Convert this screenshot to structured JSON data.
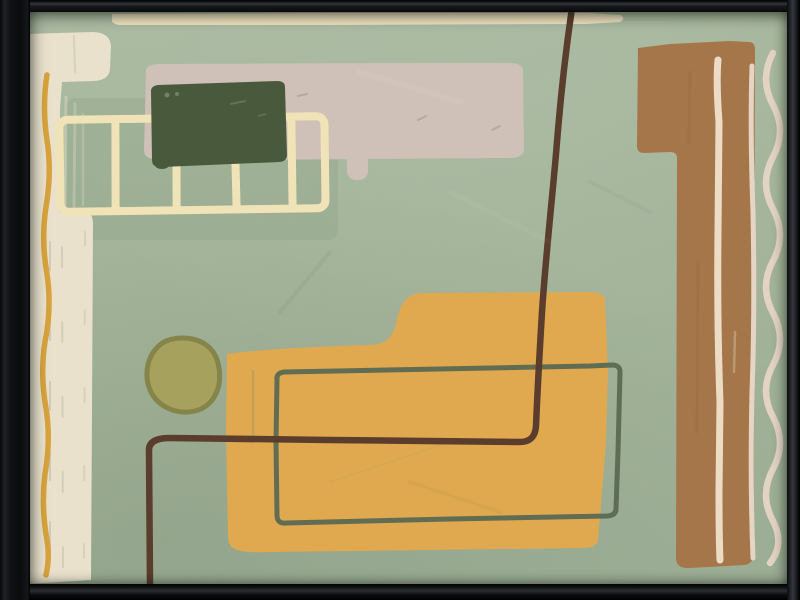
{
  "artwork": {
    "kind": "framed-abstract-painting",
    "frame": {
      "color": "#0d0e11",
      "bevel_highlight": "#33363b"
    },
    "palette": {
      "sage": "#a3b49a",
      "sage_panel": "#8ba083",
      "cream_bar": "#e9e1cc",
      "cream_streak": "#d9d5be",
      "grey_streak": "#a9ab9b",
      "top_strip": "#eee2bf",
      "ladder_cream": "#f1e3b8",
      "taupe": "#cfc1b7",
      "taupe_scratch": "#a8998f",
      "forest_green": "#49593c",
      "forest_mark": "#74855c",
      "olive_fill": "#a6a15d",
      "olive_edge": "#85854a",
      "mustard": "#e1a94f",
      "mustard_crease": "#8d9468",
      "ochre_line": "#d79f35",
      "teal_line": "#5a6952",
      "umber_line": "#5a3d2c",
      "sienna": "#a6764b",
      "sienna_shade": "#8e6038",
      "blush_line_inner": "#ecdcc6",
      "blush_line_edge": "#e6d5c5",
      "blush_wave": "#e3d3c5"
    },
    "shapes": [
      "top-strip",
      "left-cream-bar",
      "ochre-squiggle",
      "sage-panel",
      "taupe-bar",
      "ladder-grid",
      "forest-rect",
      "olive-pebble",
      "mustard-step-shape",
      "teal-outline-rect",
      "umber-bent-line",
      "sienna-column",
      "blush-inner-line",
      "blush-edge-line",
      "blush-wave-line"
    ]
  }
}
